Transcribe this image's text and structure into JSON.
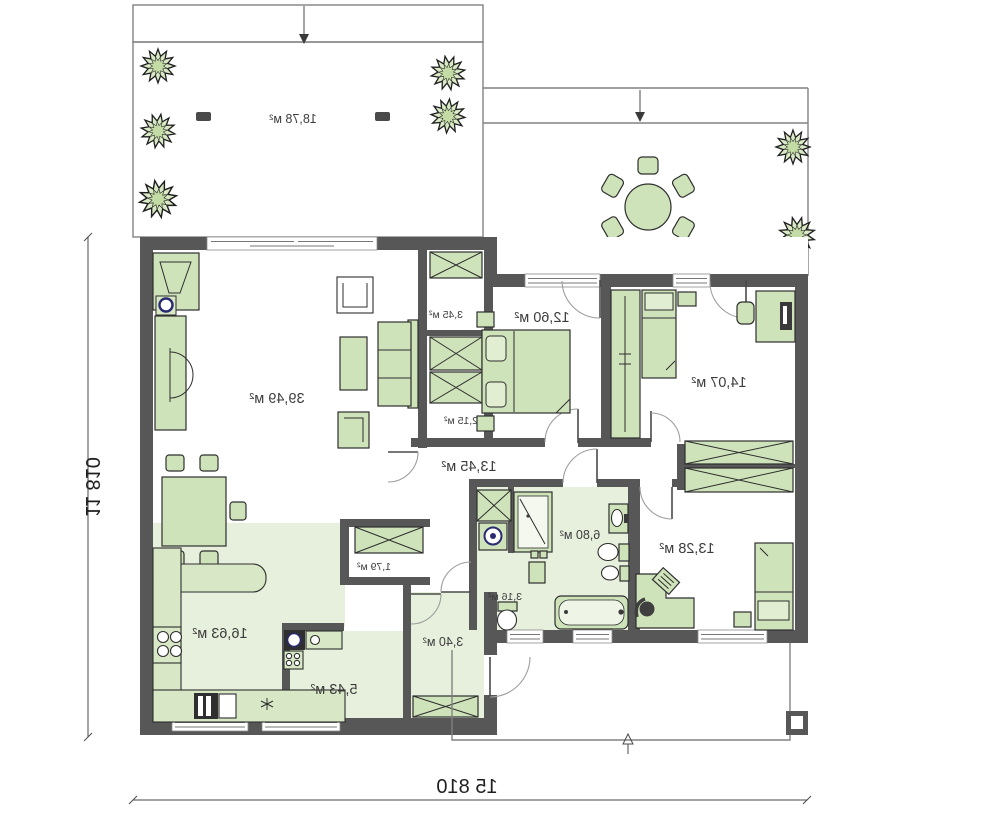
{
  "plan": {
    "type_note": "mirrored-floor-plan",
    "colors": {
      "wall": "#575757",
      "furniture": "#cfe3ba",
      "floor_tint": "#e7efdd",
      "outline": "#2e2e2e",
      "tree_fill": "#d9e9c5"
    }
  },
  "rooms": [
    {
      "id": "terrace",
      "area_label": "18,78 м²"
    },
    {
      "id": "living-room",
      "area_label": "39,49 м²"
    },
    {
      "id": "closet-a",
      "area_label": "3,45 м²"
    },
    {
      "id": "bedroom-1",
      "area_label": "12,60 м²"
    },
    {
      "id": "closet-b",
      "area_label": "2,15 м²"
    },
    {
      "id": "hall",
      "area_label": "13,45 м²"
    },
    {
      "id": "bedroom-2",
      "area_label": "14,07 м²"
    },
    {
      "id": "bathroom",
      "area_label": "6,80 м²"
    },
    {
      "id": "bedroom-3",
      "area_label": "13,28 м²"
    },
    {
      "id": "wc",
      "area_label": "3,16 м²"
    },
    {
      "id": "closet-c",
      "area_label": "1,79 м²"
    },
    {
      "id": "kitchen",
      "area_label": "16,63 м²"
    },
    {
      "id": "pantry",
      "area_label": "5,43 м²"
    },
    {
      "id": "entry-hall",
      "area_label": "3,40 м²"
    }
  ],
  "dimensions": {
    "overall_width": "15 810",
    "overall_height": "11 810"
  }
}
